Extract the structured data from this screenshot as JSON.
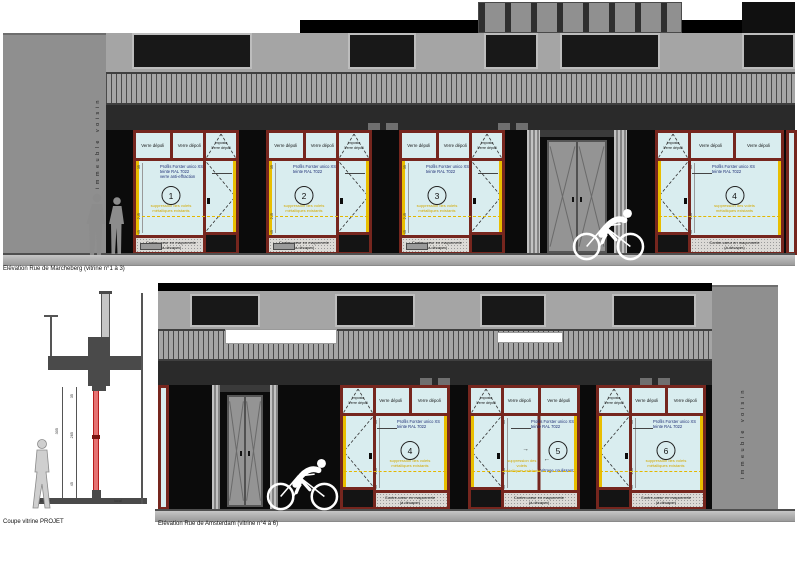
{
  "labels": {
    "verre_depoli": "Verre dépoli",
    "imposte": "Imposte",
    "contre_coeur_l1": "Contre-cœur en maçonnerie",
    "contre_coeur_l2": "(à décaper)",
    "volets_l1": "suppression des volets",
    "volets_l2": "métalliques existants",
    "vitrage_coulissant": "Vitrage coulissant",
    "immeuble_voisin": "immeuble voisin",
    "dim_transom": "35",
    "dim_window": "265",
    "dim_base": "45"
  },
  "top_elevation": {
    "caption": "Elévation Rue de Marcheberg (vitrine n°1 à 3)",
    "bays": [
      {
        "num": "1",
        "note_l1": "Profils Forster unico XS",
        "note_l2": "teinte RAL 7022",
        "note_l3": "verre anti-effraction"
      },
      {
        "num": "2",
        "note_l1": "Profils Forster unico XS",
        "note_l2": "teinte RAL 7022",
        "note_l3": ""
      },
      {
        "num": "3",
        "note_l1": "Profils Forster unico XS",
        "note_l2": "teinte RAL 7022",
        "note_l3": ""
      },
      {
        "num": "4",
        "note_l1": "Profils Forster unico XS",
        "note_l2": "teinte RAL 7022",
        "note_l3": ""
      }
    ]
  },
  "bottom_elevation": {
    "caption": "Elévation Rue de Amsterdam (vitrine n°4 à 6)",
    "bays": [
      {
        "num": "4",
        "note_l1": "Profils Forster unico XS",
        "note_l2": "teinte RAL 7022",
        "note_l3": ""
      },
      {
        "num": "5",
        "note_l1": "Profils Forster unico XS",
        "note_l2": "teinte RAL 7022",
        "note_l3": ""
      },
      {
        "num": "6",
        "note_l1": "Profils Forster unico XS",
        "note_l2": "teinte RAL 7022",
        "note_l3": ""
      }
    ]
  },
  "section": {
    "caption": "Coupe vitrine PROJET",
    "label_trottoir": "trottoir",
    "label_local": "local",
    "dim_total": "305"
  },
  "colors": {
    "frame": "#76261e",
    "glass": "#d9edef",
    "highlight": "#e9be00",
    "annotation": "#1c2c74",
    "new_glazing": "#d32f2f"
  }
}
